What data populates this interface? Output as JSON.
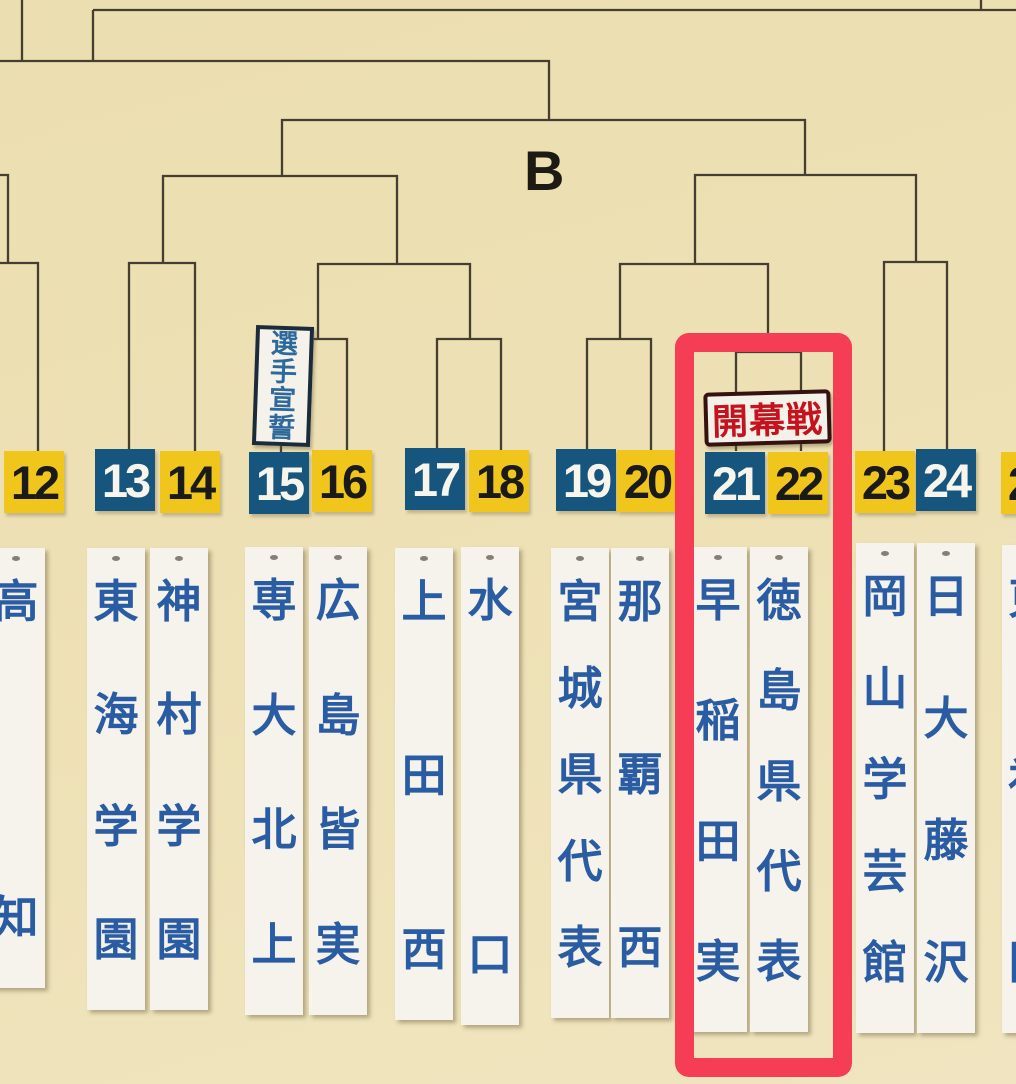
{
  "block": {
    "label": "B"
  },
  "signs": {
    "oath": {
      "label": "選手宣誓"
    },
    "opening_game": {
      "label": "開幕戦"
    }
  },
  "slots": [
    {
      "number": "12",
      "tile_color": "yellow",
      "team": "高知"
    },
    {
      "number": "13",
      "tile_color": "blue",
      "team": "東海学園"
    },
    {
      "number": "14",
      "tile_color": "yellow",
      "team": "神村学園"
    },
    {
      "number": "15",
      "tile_color": "blue",
      "team": "専大北上"
    },
    {
      "number": "16",
      "tile_color": "yellow",
      "team": "広島皆実"
    },
    {
      "number": "17",
      "tile_color": "blue",
      "team": "上田西"
    },
    {
      "number": "18",
      "tile_color": "yellow",
      "team": "水口"
    },
    {
      "number": "19",
      "tile_color": "blue",
      "team": "宮城県代表"
    },
    {
      "number": "20",
      "tile_color": "yellow",
      "team": "那覇西"
    },
    {
      "number": "21",
      "tile_color": "blue",
      "team": "早稲田実"
    },
    {
      "number": "22",
      "tile_color": "yellow",
      "team": "徳島県代表"
    },
    {
      "number": "23",
      "tile_color": "yellow",
      "team": "岡山学芸館"
    },
    {
      "number": "24",
      "tile_color": "blue",
      "team": "日大藤沢"
    },
    {
      "number": "25",
      "tile_color": "yellow",
      "team": "東福岡"
    }
  ],
  "colors": {
    "background": "#eee1b6",
    "bracket_line": "#453f31",
    "tile_yellow": "#f0c61c",
    "tile_blue": "#16567e",
    "tile_text_on_yellow": "#1a1a19",
    "tile_text_on_blue": "#f7f5ec",
    "strip_bg": "#f6f3ec",
    "strip_text": "#2a5ca3",
    "oath_text": "#2d699c",
    "oath_border": "#1c2b3a",
    "opening_text": "#c6121c",
    "opening_border": "#35120f",
    "highlight": "#f53d56"
  }
}
